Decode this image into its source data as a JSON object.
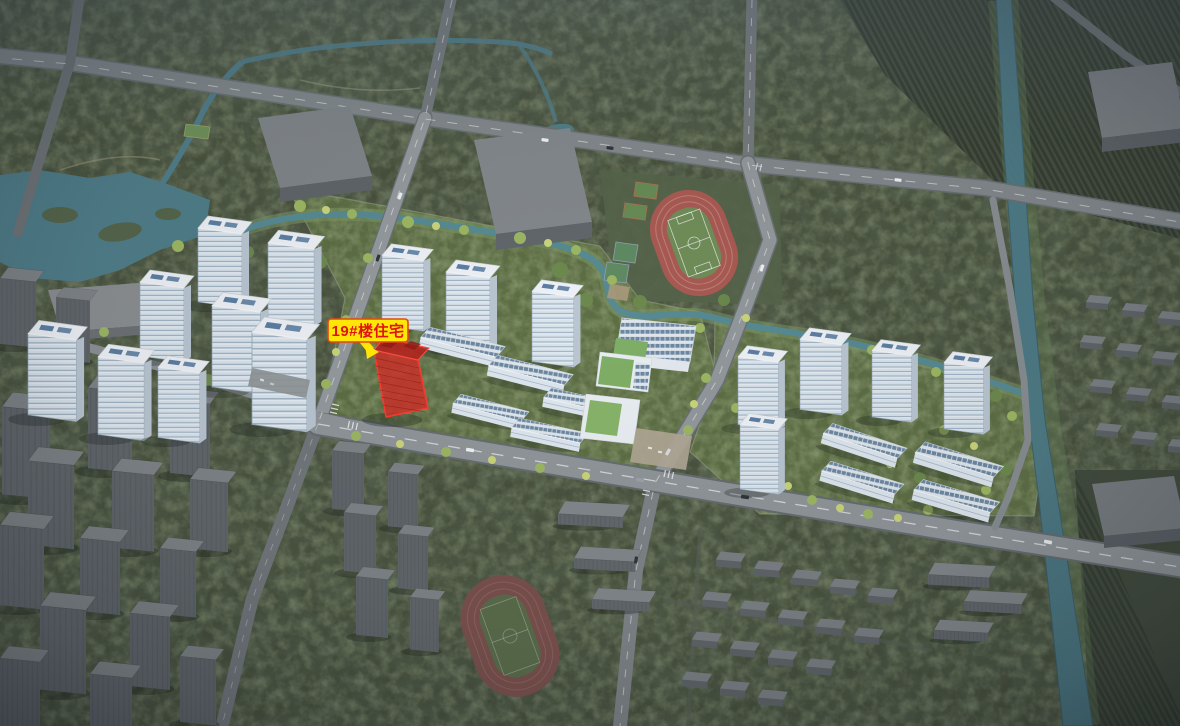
{
  "annotation": {
    "building_label": "19#楼住宅",
    "label_bg_color": "#ffe606",
    "label_text_color": "#e01414",
    "label_border_color": "#e04a10",
    "highlight_fill": "#d03028",
    "highlight_outline": "#ff3a2e"
  },
  "scene": {
    "description": "Aerial 3D rendering of residential masterplan with building 19# highlighted in red",
    "site_green": "#5d6e45",
    "context_green": "#47503c",
    "road_gray": "#8f9598",
    "water_teal": "#4f7d89",
    "track_red": "#a85a52",
    "tower_facade": "#dce6ee",
    "pv_panel_blue": "#5c7ea2"
  }
}
